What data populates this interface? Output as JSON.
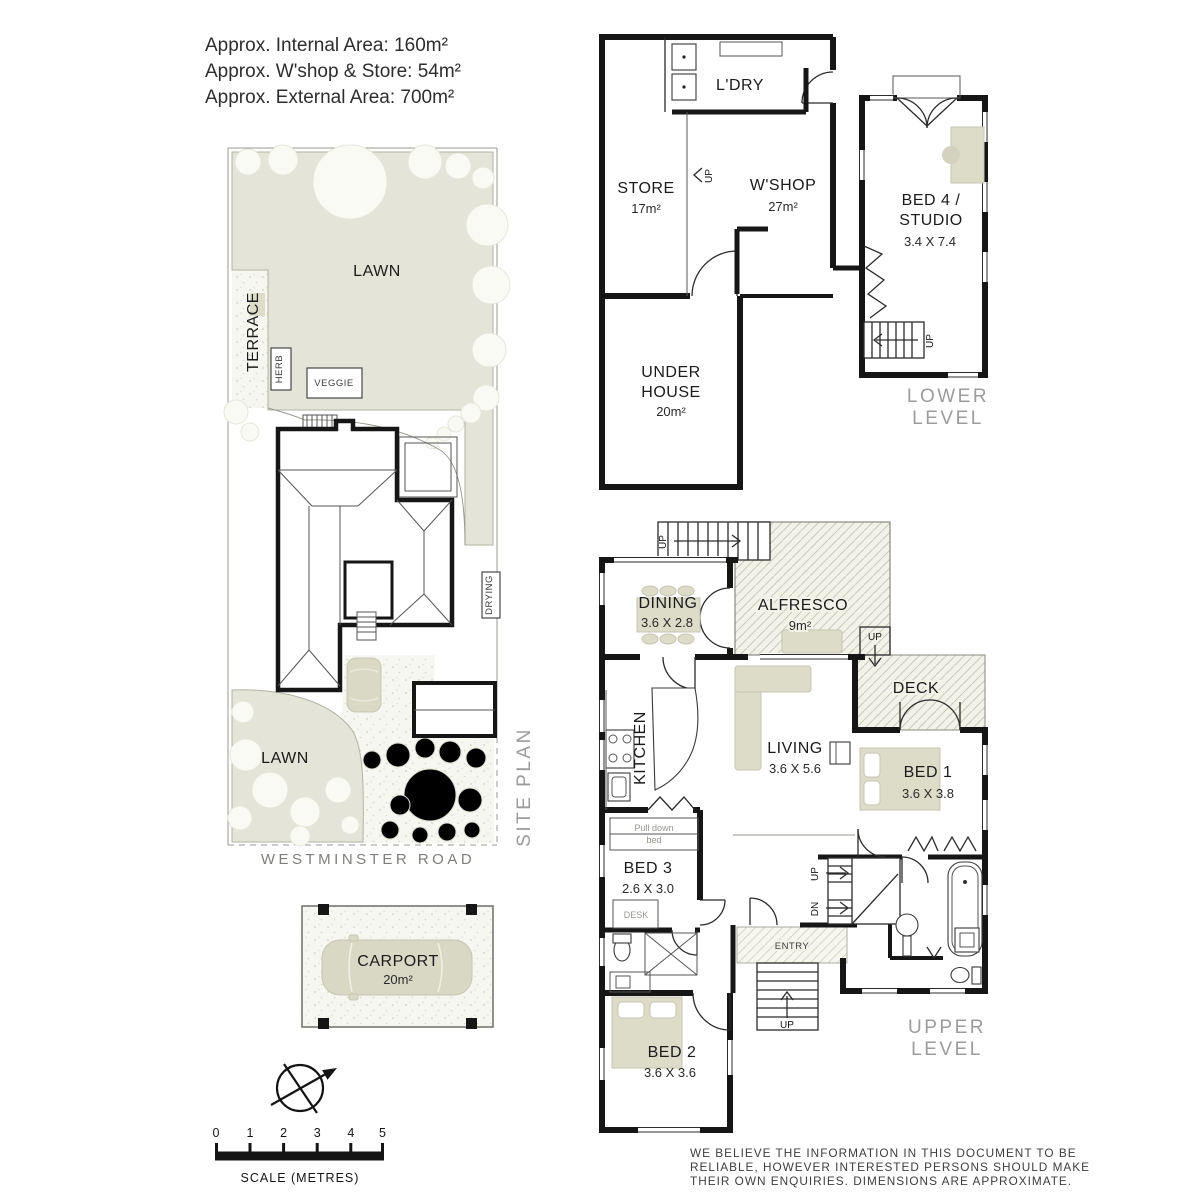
{
  "info": {
    "lines": [
      "Approx. Internal Area: 160m²",
      "Approx. W'shop & Store: 54m²",
      "Approx. External Area: 700m²"
    ]
  },
  "site_plan": {
    "lawn_top": "LAWN",
    "lawn_bottom": "LAWN",
    "terrace": "TERRACE",
    "herb": "HERB",
    "veggie": "VEGGIE",
    "drying": "DRYING",
    "road": "WESTMINSTER ROAD",
    "caption": "SITE PLAN"
  },
  "lower_level": {
    "caption": [
      "LOWER",
      "LEVEL"
    ],
    "ldry": "L'DRY",
    "store": "STORE",
    "store_area": "17m²",
    "wshop": "W'SHOP",
    "wshop_area": "27m²",
    "bed4": [
      "BED 4 /",
      "STUDIO"
    ],
    "bed4_dim": "3.4 X 7.4",
    "under_house": [
      "UNDER",
      "HOUSE"
    ],
    "under_house_area": "20m²",
    "up_store": "UP",
    "up_stairs": "UP"
  },
  "upper_level": {
    "caption": [
      "UPPER",
      "LEVEL"
    ],
    "dining": "DINING",
    "dining_dim": "3.6 X 2.8",
    "alfresco": "ALFRESCO",
    "alfresco_area": "9m²",
    "deck": "DECK",
    "kitchen": "KITCHEN",
    "living": "LIVING",
    "living_dim": "3.6 X 5.6",
    "bed1": "BED 1",
    "bed1_dim": "3.6 X 3.8",
    "bed3": "BED 3",
    "bed3_dim": "2.6 X 3.0",
    "bed2": "BED 2",
    "bed2_dim": "3.6 X 3.6",
    "entry": "ENTRY",
    "pull_down_bed": [
      "Pull down",
      "bed"
    ],
    "desk": "DESK",
    "up_top": "UP",
    "up_deck": "UP",
    "up_mid": "UP",
    "dn_mid": "DN",
    "up_entry": "UP"
  },
  "carport": {
    "name": "CARPORT",
    "area": "20m²"
  },
  "scale_bar": {
    "ticks": [
      "0",
      "1",
      "2",
      "3",
      "4",
      "5"
    ],
    "caption": "SCALE (METRES)"
  },
  "disclaimer": {
    "lines": [
      "WE BELIEVE THE INFORMATION IN THIS DOCUMENT TO BE",
      "RELIABLE, HOWEVER INTERESTED PERSONS SHOULD MAKE",
      "THEIR OWN ENQUIRIES. DIMENSIONS ARE APPROXIMATE."
    ]
  },
  "colors": {
    "lawn": "#e4e4d8",
    "furniture": "#dcdcc9",
    "wall": "#161616",
    "caption": "#9c9c9c"
  }
}
